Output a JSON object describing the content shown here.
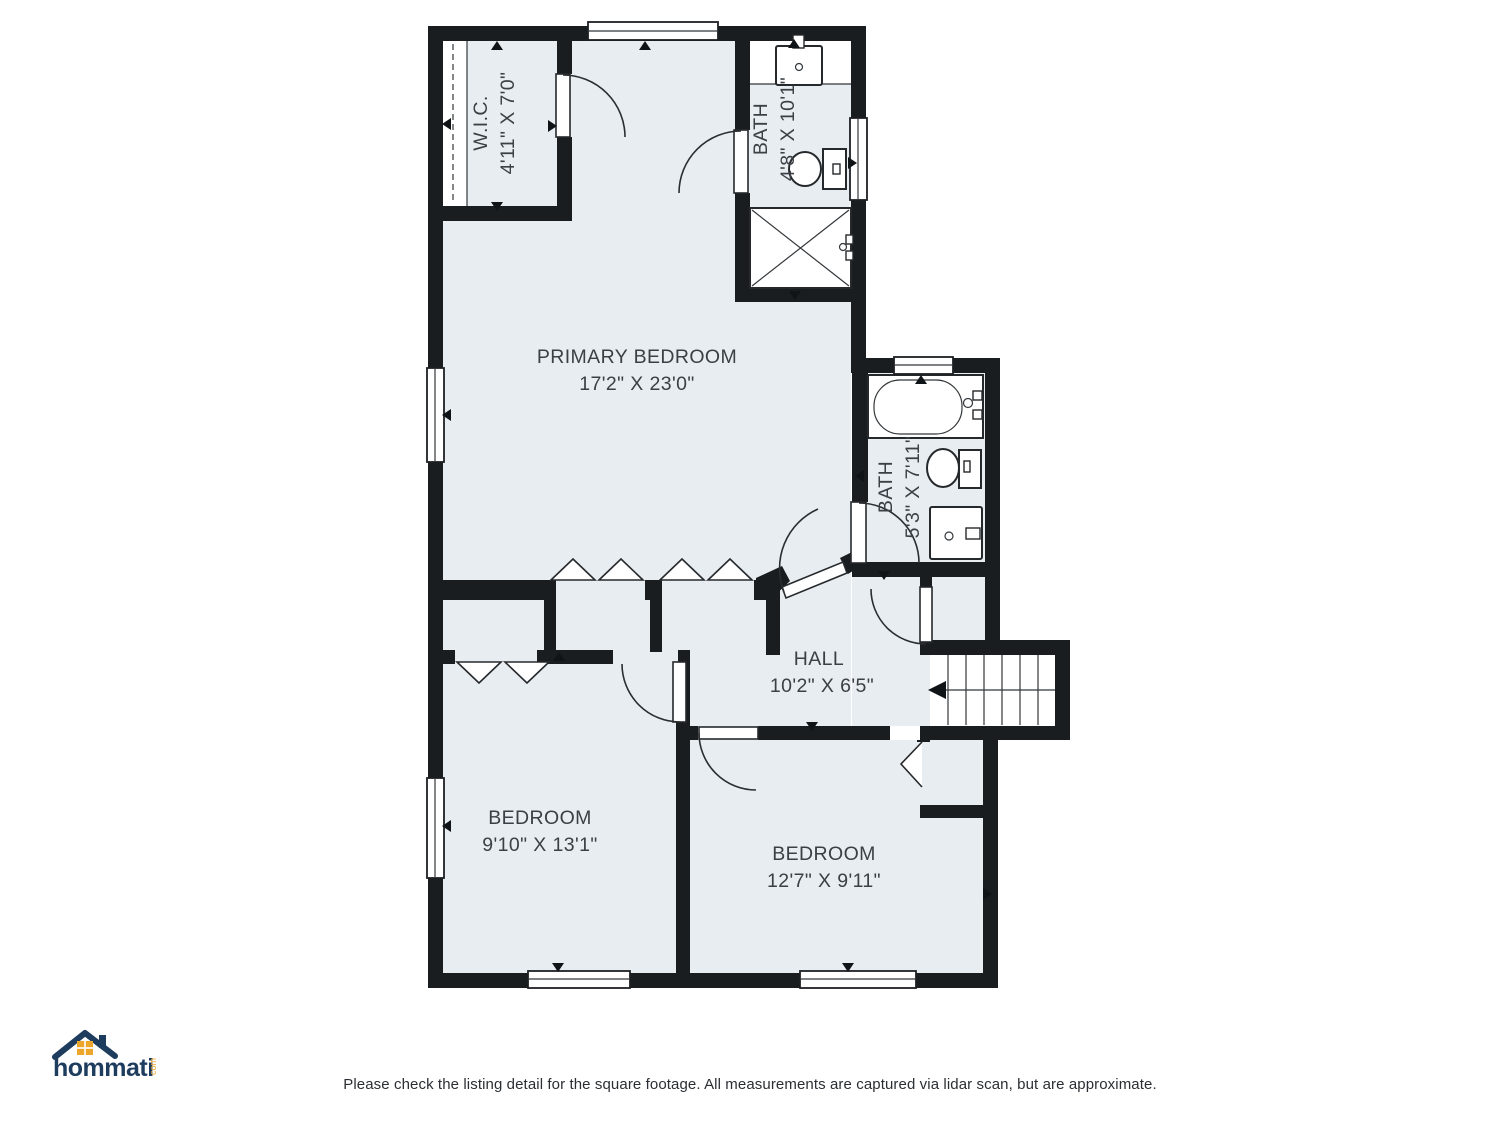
{
  "rooms": {
    "primary_bedroom": {
      "name": "PRIMARY BEDROOM",
      "dims": "17'2\" X 23'0\""
    },
    "wic": {
      "name": "W.I.C.",
      "dims": "4'11\" X 7'0\""
    },
    "bath_top": {
      "name": "BATH",
      "dims": "4'8\" X 10'1\""
    },
    "bath_right": {
      "name": "BATH",
      "dims": "5'3\" X 7'11\""
    },
    "hall": {
      "name": "HALL",
      "dims": "10'2\" X 6'5\""
    },
    "bedroom_left": {
      "name": "BEDROOM",
      "dims": "9'10\" X 13'1\""
    },
    "bedroom_right": {
      "name": "BEDROOM",
      "dims": "12'7\" X 9'11\""
    }
  },
  "branding": {
    "logo_text": "hommati",
    "logo_suffix": "com"
  },
  "footer": {
    "disclaimer": "Please check the listing detail for the square footage. All measurements are captured via lidar scan, but are approximate."
  },
  "colors": {
    "floor": "#e8edf1",
    "wall": "#1a1d20",
    "logo_navy": "#1d3c5e",
    "logo_orange": "#eda62c"
  }
}
